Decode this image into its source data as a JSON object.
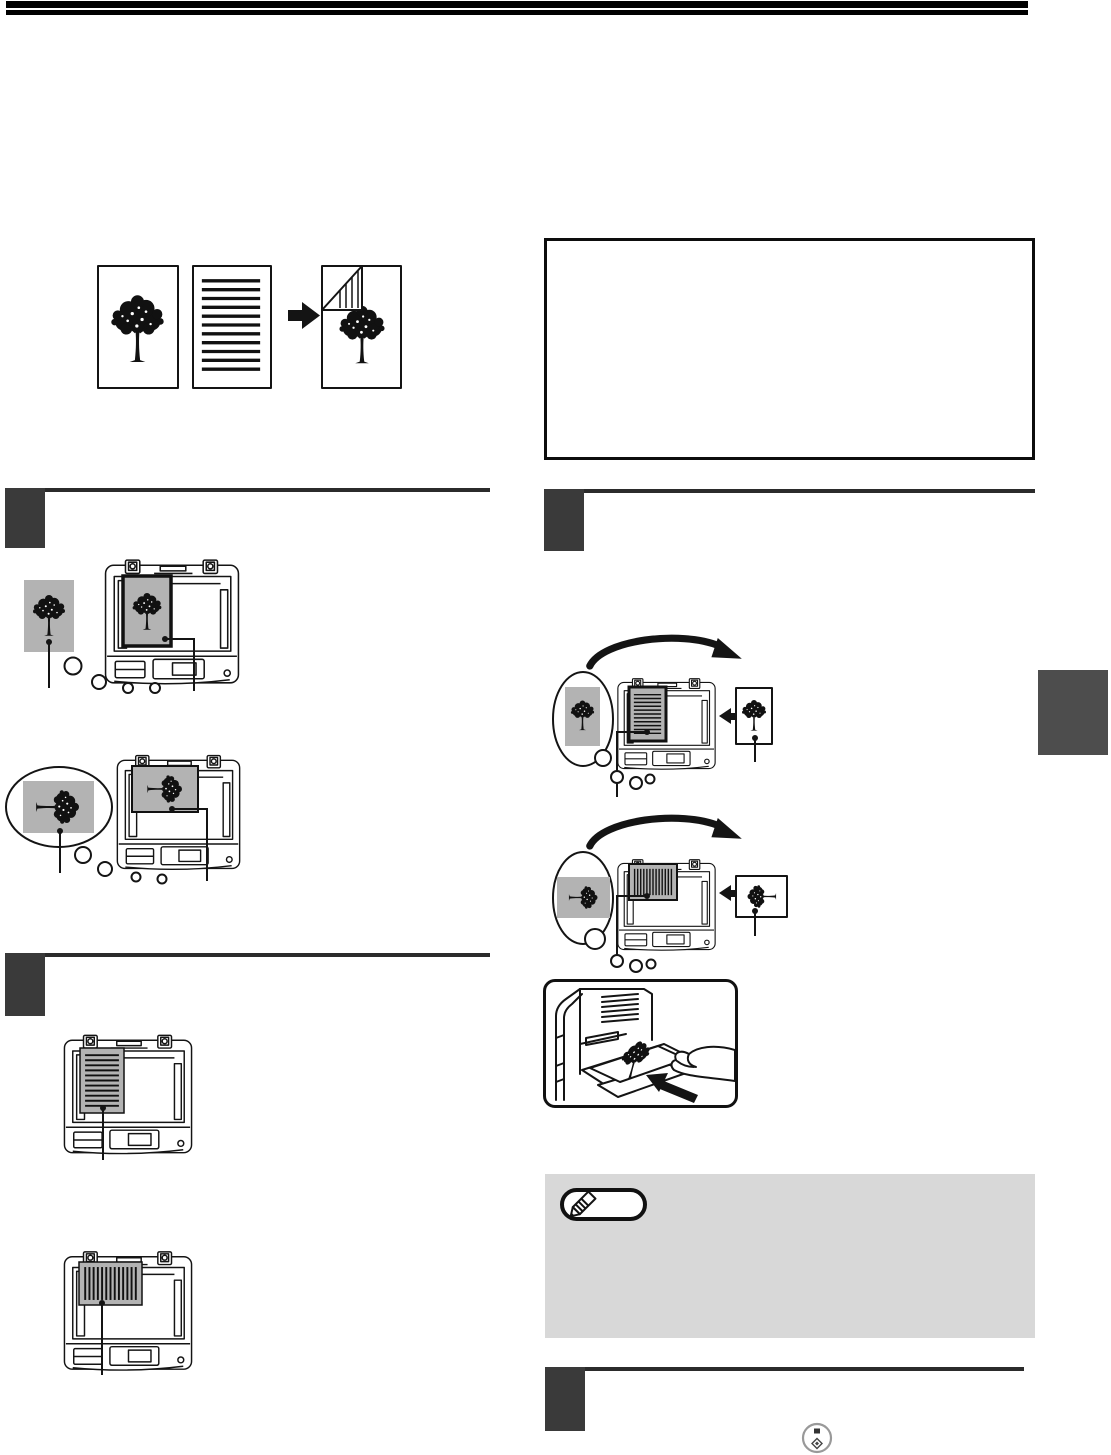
{
  "page": {
    "width_px": 1111,
    "height_px": 1455
  },
  "colors": {
    "page_background": "#ffffff",
    "header_bar": "#000000",
    "section_rule": "#2b2b2b",
    "step_block": "#3a3a3a",
    "side_tab": "#4d4d4d",
    "note_box_background": "#d8d8d8",
    "info_box_border": "#0d0d0d",
    "original_paper_gray": "#b3b3b3",
    "line_art": "#141414",
    "start_key_ring": "#999999"
  },
  "icons": {
    "pencil_icon": "✎",
    "start_key_icon": "◈",
    "transform_arrow_icon": "➡",
    "insert_arrow_icon": "⬅",
    "turn_over_arrow_icon": "⟳",
    "feed_arrow_icon": "↖"
  },
  "structure": {
    "left_column": [
      "two-sided-copy-example-illustration",
      "step-section-rule-1",
      "place-original-illustrations",
      "step-section-rule-2",
      "original-orientation-illustrations"
    ],
    "right_column": [
      "info-box",
      "step-section-rule-3",
      "turn-over-illustrations",
      "bypass-tray-illustration",
      "note-box",
      "step-section-rule-4",
      "start-key-icon"
    ],
    "page_edge": [
      "chapter-side-tab"
    ]
  },
  "visible_text": []
}
